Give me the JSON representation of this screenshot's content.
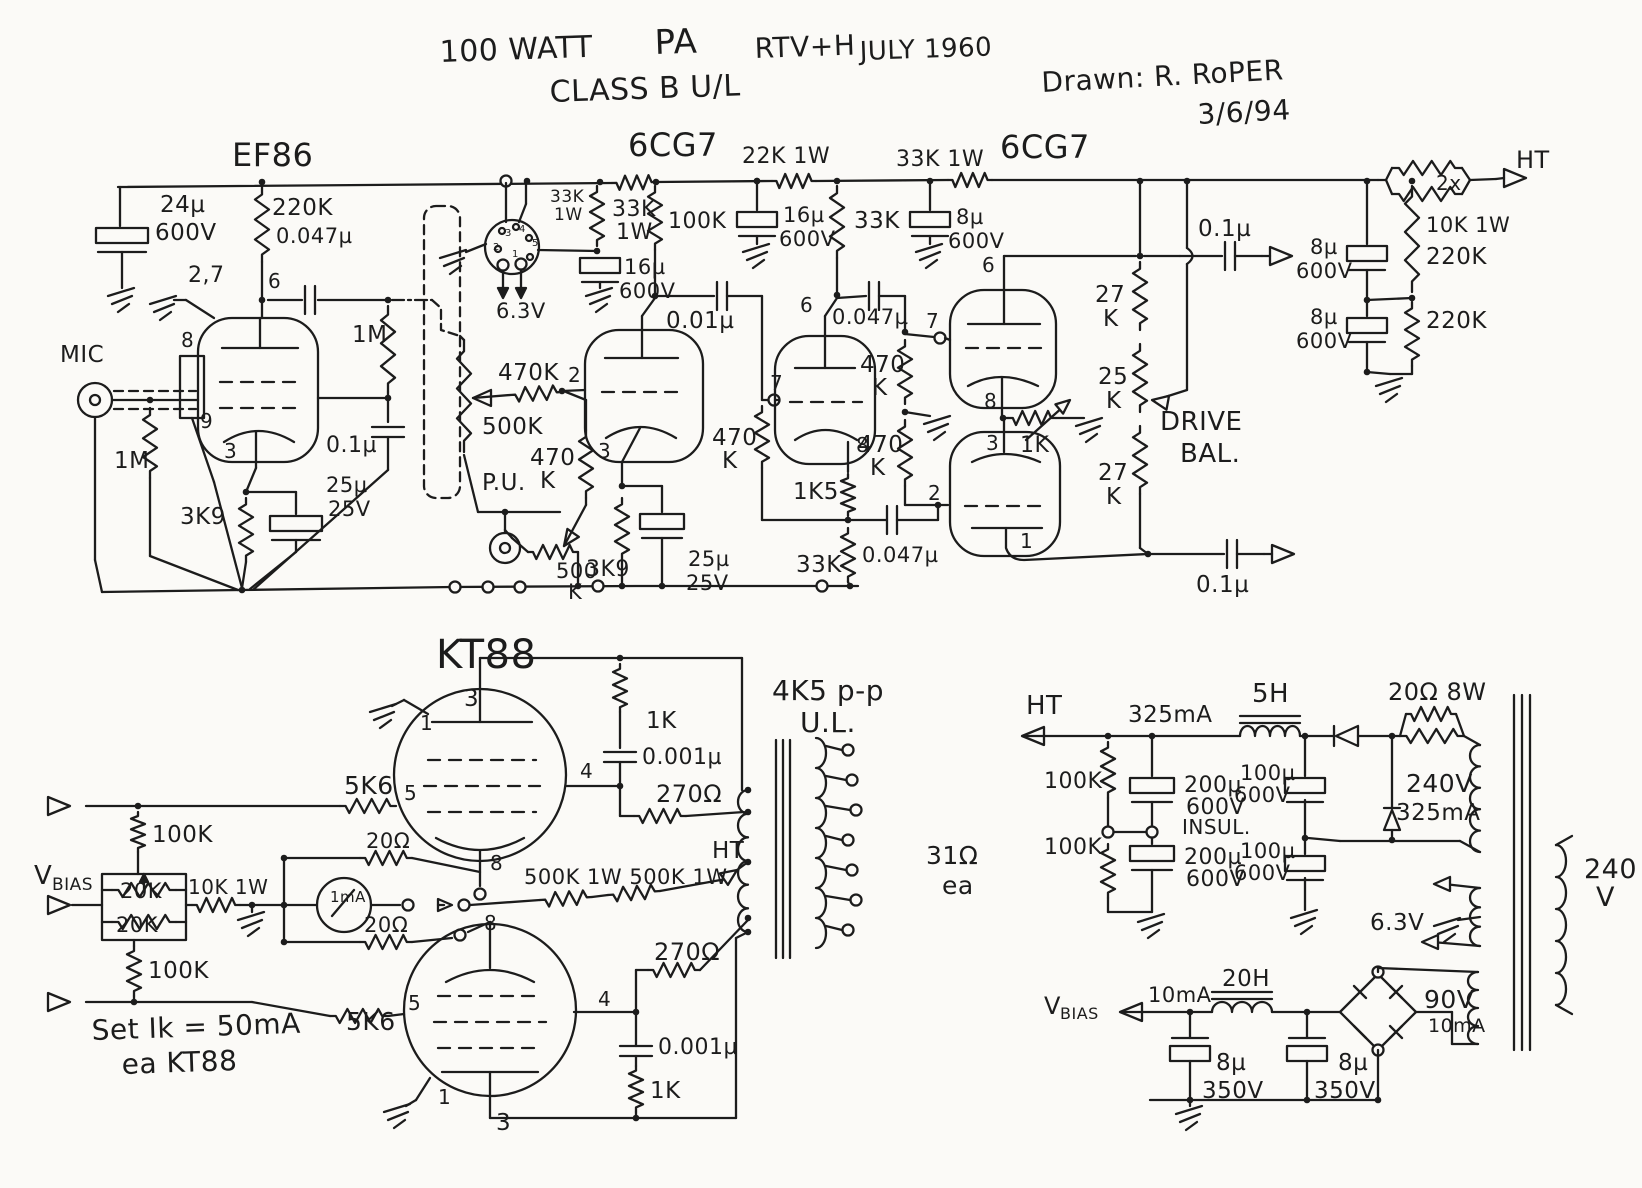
{
  "document": {
    "type": "hand-drawn schematic",
    "title": "100 WATT PA RTV+H JULY 1960",
    "subtitle": "CLASS B U/L",
    "credit": "Drawn: R. RoPER",
    "date": "3/6/94"
  },
  "colors": {
    "ink": "#1c1c1c",
    "paper": "#fbfaf7"
  },
  "schematic": {
    "tubes": [
      "EF86",
      "6CG7",
      "6CG7",
      "KT88",
      "KT88"
    ],
    "inputs": [
      "MIC",
      "P.U."
    ],
    "output_transformer": {
      "primary": "4K5 p-p U.L.",
      "secondary": "31Ω ea",
      "center_tap": "HT"
    },
    "bias_note": "Set Ik = 50mA ea KT88",
    "power_supply": {
      "ht": "325mA, 5H choke, 200µ 600V INSUL + 100µ 600V, 20Ω 8W, 240V 325mA winding",
      "bias": "VBIAS 10mA, 20H choke, 8µ 350V x2, 90V 10mA winding",
      "heater": "6.3V",
      "mains": "240 V"
    }
  },
  "labels": [
    {
      "n": "title-watt",
      "t": "100 WATT",
      "x": 440,
      "y": 62,
      "s": 30,
      "r": -2
    },
    {
      "n": "title-pa",
      "t": "PA",
      "x": 655,
      "y": 54,
      "s": 34,
      "r": -2
    },
    {
      "n": "title-rtvh",
      "t": "RTV+H",
      "x": 755,
      "y": 58,
      "s": 28,
      "r": -2
    },
    {
      "n": "title-date1",
      "t": "JULY 1960",
      "x": 860,
      "y": 60,
      "s": 26,
      "r": -2
    },
    {
      "n": "title-class",
      "t": "CLASS B U/L",
      "x": 550,
      "y": 102,
      "s": 30,
      "r": -2
    },
    {
      "n": "credit",
      "t": "Drawn: R. RoPER",
      "x": 1042,
      "y": 92,
      "s": 28,
      "r": -3
    },
    {
      "n": "credit-date",
      "t": "3/6/94",
      "x": 1198,
      "y": 124,
      "s": 28,
      "r": -3
    },
    {
      "n": "tube-ef86",
      "t": "EF86",
      "x": 232,
      "y": 166,
      "s": 32
    },
    {
      "t": "24µ",
      "x": 160,
      "y": 212,
      "s": 23
    },
    {
      "t": "600V",
      "x": 155,
      "y": 240,
      "s": 23
    },
    {
      "t": "220K",
      "x": 272,
      "y": 215,
      "s": 23
    },
    {
      "t": "0.047µ",
      "x": 276,
      "y": 243,
      "s": 21
    },
    {
      "t": "2,7",
      "x": 188,
      "y": 282,
      "s": 22
    },
    {
      "t": "6",
      "x": 268,
      "y": 288,
      "s": 20
    },
    {
      "t": "8",
      "x": 181,
      "y": 347,
      "s": 20
    },
    {
      "n": "input-mic",
      "t": "MIC",
      "x": 60,
      "y": 362,
      "s": 23
    },
    {
      "t": "1M",
      "x": 352,
      "y": 342,
      "s": 23
    },
    {
      "t": "9",
      "x": 200,
      "y": 428,
      "s": 20
    },
    {
      "t": "3",
      "x": 224,
      "y": 458,
      "s": 20
    },
    {
      "t": "1M",
      "x": 114,
      "y": 468,
      "s": 23
    },
    {
      "t": "0.1µ",
      "x": 326,
      "y": 452,
      "s": 22
    },
    {
      "t": "3K9",
      "x": 180,
      "y": 524,
      "s": 23
    },
    {
      "t": "25µ",
      "x": 326,
      "y": 492,
      "s": 21
    },
    {
      "t": "25V",
      "x": 328,
      "y": 516,
      "s": 21
    },
    {
      "t": "33K",
      "x": 550,
      "y": 202,
      "s": 17
    },
    {
      "t": "1W",
      "x": 554,
      "y": 220,
      "s": 17
    },
    {
      "t": "33K",
      "x": 612,
      "y": 216,
      "s": 22
    },
    {
      "t": "1W",
      "x": 616,
      "y": 239,
      "s": 22
    },
    {
      "t": "16µ",
      "x": 624,
      "y": 274,
      "s": 21
    },
    {
      "t": "600V",
      "x": 619,
      "y": 298,
      "s": 21
    },
    {
      "t": "6.3V",
      "x": 496,
      "y": 318,
      "s": 21
    },
    {
      "t": "3",
      "x": 505,
      "y": 236,
      "s": 10
    },
    {
      "t": "4",
      "x": 519,
      "y": 232,
      "s": 10
    },
    {
      "t": "2",
      "x": 493,
      "y": 250,
      "s": 10
    },
    {
      "t": "5",
      "x": 532,
      "y": 246,
      "s": 10
    },
    {
      "t": "1",
      "x": 512,
      "y": 257,
      "s": 10
    },
    {
      "t": "100K",
      "x": 668,
      "y": 228,
      "s": 22
    },
    {
      "n": "tube-6cg7-1",
      "t": "6CG7",
      "x": 628,
      "y": 156,
      "s": 32
    },
    {
      "t": "22K 1W",
      "x": 742,
      "y": 163,
      "s": 22
    },
    {
      "t": "16µ",
      "x": 783,
      "y": 222,
      "s": 21
    },
    {
      "t": "600V",
      "x": 779,
      "y": 246,
      "s": 21
    },
    {
      "t": "33K",
      "x": 854,
      "y": 228,
      "s": 23
    },
    {
      "t": "0.01µ",
      "x": 666,
      "y": 328,
      "s": 23
    },
    {
      "t": "2",
      "x": 568,
      "y": 382,
      "s": 20
    },
    {
      "t": "470K",
      "x": 498,
      "y": 380,
      "s": 23
    },
    {
      "t": "500K",
      "x": 482,
      "y": 434,
      "s": 23
    },
    {
      "n": "input-pu",
      "t": "P.U.",
      "x": 482,
      "y": 490,
      "s": 23
    },
    {
      "t": "470",
      "x": 530,
      "y": 465,
      "s": 23
    },
    {
      "t": "K",
      "x": 540,
      "y": 488,
      "s": 23
    },
    {
      "t": "500",
      "x": 556,
      "y": 578,
      "s": 21
    },
    {
      "t": "K",
      "x": 568,
      "y": 599,
      "s": 21
    },
    {
      "t": "3",
      "x": 598,
      "y": 458,
      "s": 20
    },
    {
      "t": "3K9",
      "x": 586,
      "y": 576,
      "s": 22
    },
    {
      "t": "25µ",
      "x": 688,
      "y": 566,
      "s": 21
    },
    {
      "t": "25V",
      "x": 686,
      "y": 590,
      "s": 21
    },
    {
      "t": "7",
      "x": 770,
      "y": 390,
      "s": 20
    },
    {
      "t": "6",
      "x": 800,
      "y": 312,
      "s": 20
    },
    {
      "t": "470",
      "x": 712,
      "y": 445,
      "s": 23
    },
    {
      "t": "K",
      "x": 722,
      "y": 468,
      "s": 23
    },
    {
      "t": "8",
      "x": 856,
      "y": 452,
      "s": 20
    },
    {
      "t": "1K5",
      "x": 793,
      "y": 499,
      "s": 23
    },
    {
      "t": "33K",
      "x": 796,
      "y": 572,
      "s": 23
    },
    {
      "t": "0.047µ",
      "x": 862,
      "y": 562,
      "s": 21
    },
    {
      "t": "0.047µ",
      "x": 832,
      "y": 324,
      "s": 21
    },
    {
      "t": "470",
      "x": 860,
      "y": 372,
      "s": 23
    },
    {
      "t": "K",
      "x": 872,
      "y": 395,
      "s": 23
    },
    {
      "t": "470",
      "x": 858,
      "y": 452,
      "s": 23
    },
    {
      "t": "K",
      "x": 870,
      "y": 475,
      "s": 23
    },
    {
      "t": "33K 1W",
      "x": 896,
      "y": 166,
      "s": 22
    },
    {
      "n": "tube-6cg7-2",
      "t": "6CG7",
      "x": 1000,
      "y": 158,
      "s": 32
    },
    {
      "t": "8µ",
      "x": 956,
      "y": 224,
      "s": 21
    },
    {
      "t": "600V",
      "x": 948,
      "y": 248,
      "s": 21
    },
    {
      "t": "6",
      "x": 982,
      "y": 272,
      "s": 20
    },
    {
      "t": "7",
      "x": 926,
      "y": 328,
      "s": 20
    },
    {
      "t": "27",
      "x": 1095,
      "y": 302,
      "s": 23
    },
    {
      "t": "K",
      "x": 1103,
      "y": 326,
      "s": 23
    },
    {
      "t": "25",
      "x": 1098,
      "y": 384,
      "s": 23
    },
    {
      "t": "K",
      "x": 1106,
      "y": 408,
      "s": 23
    },
    {
      "t": "8",
      "x": 984,
      "y": 408,
      "s": 20
    },
    {
      "t": "1K",
      "x": 1020,
      "y": 452,
      "s": 22
    },
    {
      "t": "3",
      "x": 986,
      "y": 450,
      "s": 20
    },
    {
      "n": "drive-bal-1",
      "t": "DRIVE",
      "x": 1160,
      "y": 430,
      "s": 26
    },
    {
      "n": "drive-bal-2",
      "t": "BAL.",
      "x": 1180,
      "y": 462,
      "s": 26
    },
    {
      "t": "27",
      "x": 1098,
      "y": 480,
      "s": 23
    },
    {
      "t": "K",
      "x": 1106,
      "y": 504,
      "s": 23
    },
    {
      "t": "2",
      "x": 928,
      "y": 500,
      "s": 20
    },
    {
      "t": "1",
      "x": 1020,
      "y": 548,
      "s": 20
    },
    {
      "t": "0.1µ",
      "x": 1198,
      "y": 236,
      "s": 23
    },
    {
      "t": "0.1µ",
      "x": 1196,
      "y": 592,
      "s": 23
    },
    {
      "t": "8µ",
      "x": 1310,
      "y": 254,
      "s": 21
    },
    {
      "t": "600V",
      "x": 1296,
      "y": 278,
      "s": 21
    },
    {
      "t": "8µ",
      "x": 1310,
      "y": 324,
      "s": 21
    },
    {
      "t": "600V",
      "x": 1296,
      "y": 348,
      "s": 21
    },
    {
      "t": "220K",
      "x": 1426,
      "y": 264,
      "s": 23
    },
    {
      "t": "220K",
      "x": 1426,
      "y": 328,
      "s": 23
    },
    {
      "t": "2x",
      "x": 1436,
      "y": 190,
      "s": 20
    },
    {
      "t": "10K 1W",
      "x": 1426,
      "y": 232,
      "s": 21
    },
    {
      "n": "ht-top",
      "t": "HT",
      "x": 1516,
      "y": 168,
      "s": 24
    },
    {
      "n": "tube-kt88",
      "t": "KT88",
      "x": 436,
      "y": 668,
      "s": 40
    },
    {
      "t": "3",
      "x": 464,
      "y": 706,
      "s": 23
    },
    {
      "t": "1",
      "x": 420,
      "y": 730,
      "s": 20
    },
    {
      "t": "5K6",
      "x": 344,
      "y": 794,
      "s": 25
    },
    {
      "t": "5",
      "x": 404,
      "y": 800,
      "s": 20
    },
    {
      "t": "4",
      "x": 580,
      "y": 778,
      "s": 20
    },
    {
      "t": "8",
      "x": 490,
      "y": 870,
      "s": 20
    },
    {
      "t": "1K",
      "x": 646,
      "y": 728,
      "s": 23
    },
    {
      "t": "0.001µ",
      "x": 642,
      "y": 764,
      "s": 22
    },
    {
      "t": "270Ω",
      "x": 656,
      "y": 802,
      "s": 24
    },
    {
      "t": "20Ω",
      "x": 366,
      "y": 848,
      "s": 21
    },
    {
      "n": "meter-1ma",
      "t": "1mA",
      "x": 330,
      "y": 902,
      "s": 15
    },
    {
      "t": "500K 1W 500K 1W",
      "x": 524,
      "y": 884,
      "s": 21
    },
    {
      "n": "ht-ct",
      "t": "HT",
      "x": 712,
      "y": 858,
      "s": 23
    },
    {
      "t": "20Ω",
      "x": 364,
      "y": 932,
      "s": 21
    },
    {
      "t": "8",
      "x": 484,
      "y": 930,
      "s": 20
    },
    {
      "t": "5K6",
      "x": 346,
      "y": 1030,
      "s": 25
    },
    {
      "t": "5",
      "x": 408,
      "y": 1010,
      "s": 20
    },
    {
      "t": "4",
      "x": 598,
      "y": 1006,
      "s": 20
    },
    {
      "t": "270Ω",
      "x": 654,
      "y": 960,
      "s": 24
    },
    {
      "t": "0.001µ",
      "x": 658,
      "y": 1054,
      "s": 22
    },
    {
      "t": "1K",
      "x": 650,
      "y": 1098,
      "s": 23
    },
    {
      "t": "3",
      "x": 496,
      "y": 1130,
      "s": 23
    },
    {
      "t": "1",
      "x": 438,
      "y": 1104,
      "s": 20
    },
    {
      "n": "vbias-left-1",
      "t": "V",
      "x": 34,
      "y": 884,
      "s": 26
    },
    {
      "n": "vbias-left-2",
      "t": "BIAS",
      "x": 52,
      "y": 890,
      "s": 17
    },
    {
      "t": "100K",
      "x": 152,
      "y": 842,
      "s": 23
    },
    {
      "t": "20K",
      "x": 120,
      "y": 898,
      "s": 21
    },
    {
      "t": "20K",
      "x": 116,
      "y": 932,
      "s": 21
    },
    {
      "t": "10K 1W",
      "x": 188,
      "y": 894,
      "s": 20
    },
    {
      "t": "100K",
      "x": 148,
      "y": 978,
      "s": 23
    },
    {
      "n": "bias-note-1",
      "t": "Set Ik = 50mA",
      "x": 92,
      "y": 1040,
      "s": 28,
      "r": -2
    },
    {
      "n": "bias-note-2",
      "t": "ea KT88",
      "x": 122,
      "y": 1074,
      "s": 28,
      "r": -2
    },
    {
      "n": "opt-imp",
      "t": "4K5 p-p",
      "x": 772,
      "y": 700,
      "s": 28
    },
    {
      "n": "opt-ul",
      "t": "U.L.",
      "x": 800,
      "y": 732,
      "s": 28
    },
    {
      "t": "31Ω",
      "x": 926,
      "y": 864,
      "s": 25
    },
    {
      "t": "ea",
      "x": 942,
      "y": 894,
      "s": 25
    },
    {
      "n": "ht-psu",
      "t": "HT",
      "x": 1026,
      "y": 714,
      "s": 26
    },
    {
      "t": "325mA",
      "x": 1128,
      "y": 722,
      "s": 23
    },
    {
      "t": "5H",
      "x": 1252,
      "y": 702,
      "s": 26
    },
    {
      "t": "100K",
      "x": 1044,
      "y": 788,
      "s": 22
    },
    {
      "t": "100K",
      "x": 1044,
      "y": 854,
      "s": 22
    },
    {
      "t": "200µ",
      "x": 1184,
      "y": 792,
      "s": 22
    },
    {
      "t": "600V",
      "x": 1186,
      "y": 814,
      "s": 22
    },
    {
      "t": "INSUL.",
      "x": 1182,
      "y": 834,
      "s": 20
    },
    {
      "t": "200µ",
      "x": 1184,
      "y": 864,
      "s": 22
    },
    {
      "t": "600V",
      "x": 1186,
      "y": 886,
      "s": 22
    },
    {
      "t": "100µ",
      "x": 1240,
      "y": 780,
      "s": 21
    },
    {
      "t": "600V",
      "x": 1234,
      "y": 802,
      "s": 21
    },
    {
      "t": "100µ",
      "x": 1240,
      "y": 858,
      "s": 21
    },
    {
      "t": "600V",
      "x": 1234,
      "y": 880,
      "s": 21
    },
    {
      "t": "20Ω 8W",
      "x": 1388,
      "y": 700,
      "s": 24
    },
    {
      "t": "240V",
      "x": 1406,
      "y": 792,
      "s": 25
    },
    {
      "t": "325mA",
      "x": 1396,
      "y": 820,
      "s": 23
    },
    {
      "n": "mains-1",
      "t": "240",
      "x": 1584,
      "y": 878,
      "s": 27
    },
    {
      "n": "mains-2",
      "t": "V",
      "x": 1596,
      "y": 906,
      "s": 27
    },
    {
      "t": "6.3V",
      "x": 1370,
      "y": 930,
      "s": 23
    },
    {
      "n": "vbias-psu-1",
      "t": "V",
      "x": 1044,
      "y": 1014,
      "s": 24
    },
    {
      "n": "vbias-psu-2",
      "t": "BIAS",
      "x": 1060,
      "y": 1019,
      "s": 16
    },
    {
      "t": "10mA",
      "x": 1148,
      "y": 1002,
      "s": 21
    },
    {
      "t": "20H",
      "x": 1222,
      "y": 986,
      "s": 23
    },
    {
      "t": "8µ",
      "x": 1216,
      "y": 1070,
      "s": 23
    },
    {
      "t": "350V",
      "x": 1202,
      "y": 1098,
      "s": 23
    },
    {
      "t": "8µ",
      "x": 1338,
      "y": 1070,
      "s": 23
    },
    {
      "t": "350V",
      "x": 1314,
      "y": 1098,
      "s": 23
    },
    {
      "t": "90V",
      "x": 1424,
      "y": 1008,
      "s": 25
    },
    {
      "t": "10mA",
      "x": 1428,
      "y": 1032,
      "s": 19
    }
  ]
}
